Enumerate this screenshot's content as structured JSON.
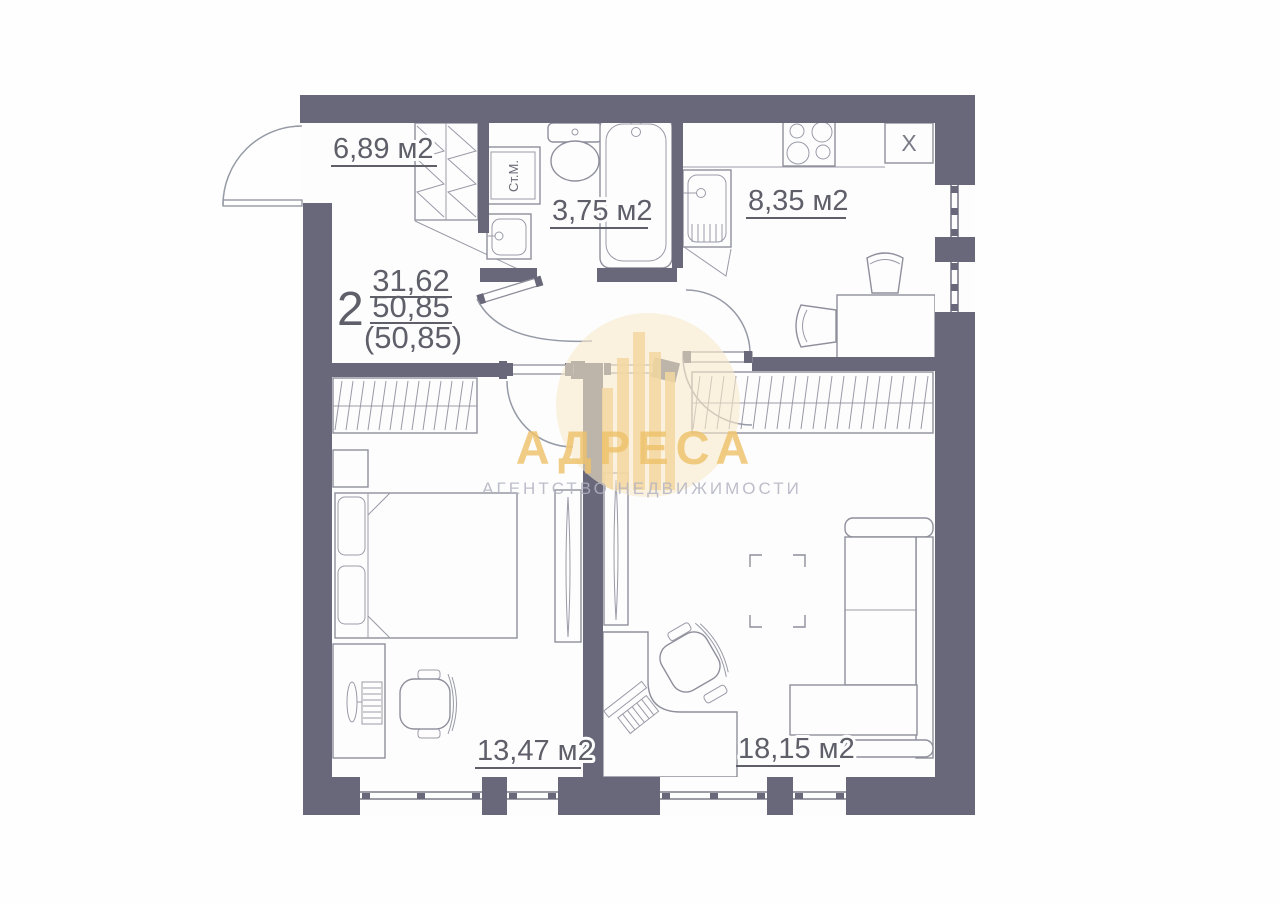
{
  "apartment": {
    "rooms_count": "2",
    "area_upper": "31,62",
    "area_lower": "50,85",
    "area_paren": "(50,85)"
  },
  "rooms": {
    "hallway": {
      "area": "6,89 м2"
    },
    "bathroom": {
      "area": "3,75 м2"
    },
    "kitchen": {
      "area": "8,35 м2"
    },
    "bedroom": {
      "area": "13,47 м2"
    },
    "living": {
      "area": "18,15 м2"
    }
  },
  "labels": {
    "washing_machine": "Ст.М.",
    "vent": "X"
  },
  "watermark": {
    "title": "АДРЕСА",
    "subtitle": "АГЕНТСТВО НЕДВИЖИМОСТИ"
  },
  "colors": {
    "wall": "#68687a",
    "furniture_line": "#8f8f9c",
    "text": "#5f5f6a",
    "watermark_gold": "#eec26b",
    "watermark_circle": "#f8e9c9",
    "watermark_subtitle": "#b3b3c2"
  }
}
